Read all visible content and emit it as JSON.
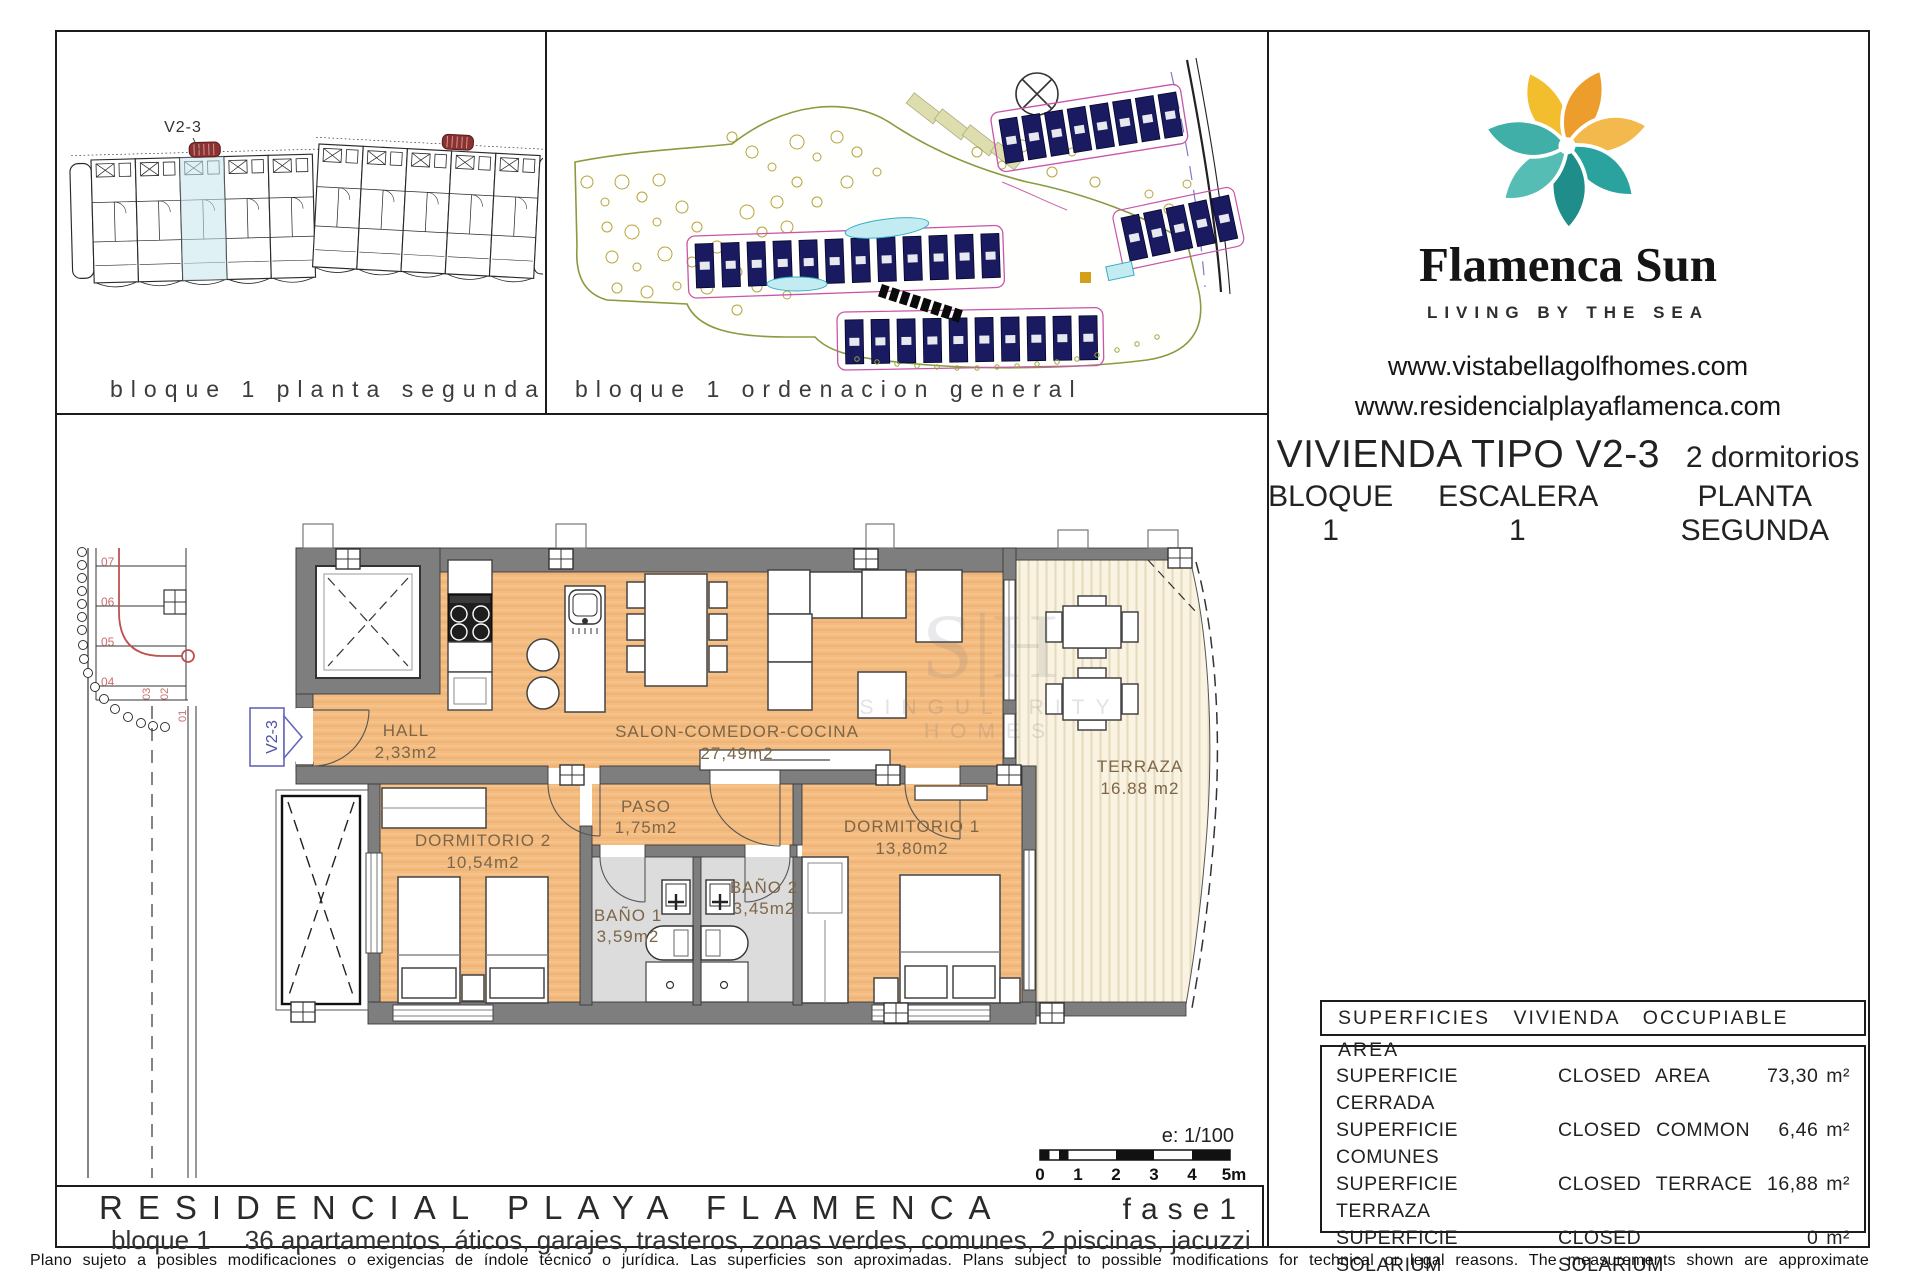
{
  "block_plan": {
    "caption": "bloque 1 planta segunda",
    "unit_label": "V2-3"
  },
  "site_plan": {
    "caption": "bloque 1 ordenacion general"
  },
  "brand": {
    "name": "Flamenca Sun",
    "tagline": "LIVING BY THE SEA",
    "website1": "www.vistabellagolfhomes.com",
    "website2": "www.residencialplayaflamenca.com",
    "logo_teal": "#2AA39E",
    "logo_orange": "#EC9D2B"
  },
  "unit": {
    "title": "VIVIENDA TIPO V2-3",
    "bedrooms": "2 dormitorios",
    "block": "BLOQUE 1",
    "stair": "ESCALERA 1",
    "floor": "PLANTA SEGUNDA"
  },
  "floorplan": {
    "tag": "V2-3",
    "floor_color": "#F3BB80",
    "wall_color": "#7E7E7E",
    "rooms": {
      "hall": {
        "name": "HALL",
        "area": "2,33m2"
      },
      "salon": {
        "name": "SALON-COMEDOR-COCINA",
        "area": "27,49m2"
      },
      "paso": {
        "name": "PASO",
        "area": "1,75m2"
      },
      "dorm2": {
        "name": "DORMITORIO 2",
        "area": "10,54m2"
      },
      "dorm1": {
        "name": "DORMITORIO 1",
        "area": "13,80m2"
      },
      "bano1": {
        "name": "BAÑO 1",
        "area": "3,59m2"
      },
      "bano2": {
        "name": "BAÑO 2",
        "area": "3,45m2"
      },
      "terraza": {
        "name": "TERRAZA",
        "area": "16.88 m2"
      }
    },
    "stair_steps": [
      "07",
      "06",
      "05",
      "04",
      "03",
      "02",
      "01"
    ],
    "scale": {
      "label": "e: 1/100",
      "ticks": [
        "0",
        "1",
        "2",
        "3",
        "4",
        "5m"
      ]
    }
  },
  "areas_table": {
    "header": "SUPERFICIES VIVIENDA OCCUPIABLE AREA",
    "rows": [
      {
        "es": "SUPERFICIE CERRADA",
        "en": "CLOSED AREA",
        "value": "73,30 m²"
      },
      {
        "es": "SUPERFICIE COMUNES",
        "en": "CLOSED COMMON",
        "value": "6,46 m²"
      },
      {
        "es": "SUPERFICIE TERRAZA",
        "en": "CLOSED TERRACE",
        "value": "16,88 m²"
      },
      {
        "es": "SUPERFICIE SOLARIUM",
        "en": "CLOSED SOLARIUM",
        "value": "0 m²"
      }
    ],
    "total_label": "TOTAL SUPERFICIE VIVIENDA",
    "total_value": "96,64 m²"
  },
  "footer": {
    "title": "RESIDENCIAL PLAYA FLAMENCA",
    "phase": "fase1",
    "subtitle_prefix": "bloque 1",
    "subtitle": "36 apartamentos, áticos, garajes, trasteros, zonas verdes, comunes, 2 piscinas, jacuzzi",
    "disclaimer": "Plano sujeto a posibles modificaciones o exigencias de índole técnico o jurídica. Las superficies son aproximadas. Plans subject to possible modifications for technical or legal reasons. The measurements shown are approximate"
  },
  "watermark": {
    "initials": "S|H",
    "label": "SINGULARITY HOMES"
  }
}
